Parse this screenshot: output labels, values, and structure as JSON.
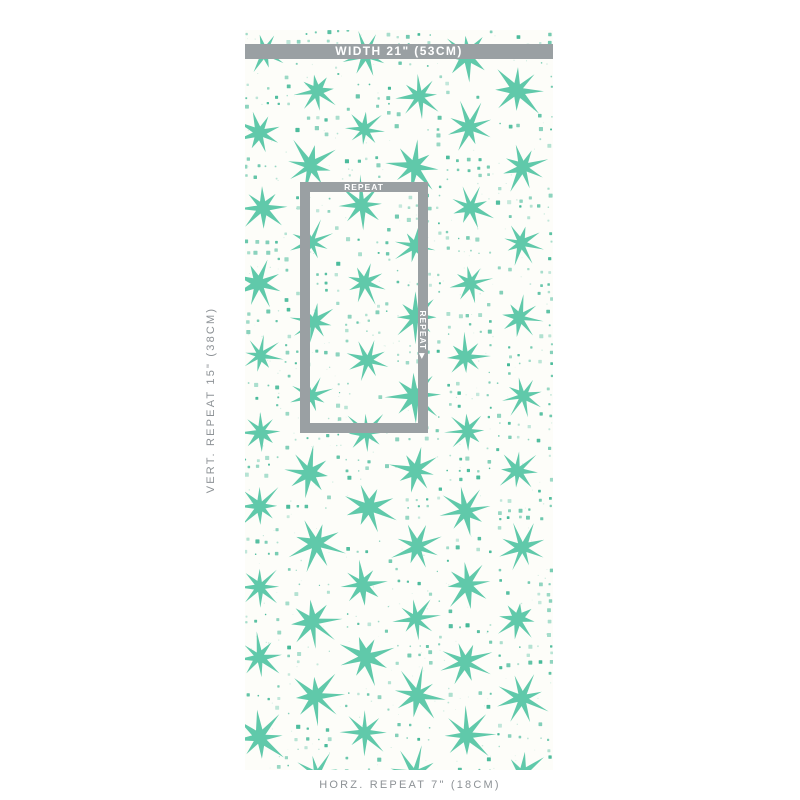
{
  "annotations": {
    "width_label": "WIDTH 21\" (53CM)",
    "vert_repeat_label": "VERT. REPEAT 15\" (38CM)",
    "horz_repeat_label": "HORZ. REPEAT 7\" (18CM)",
    "repeat_label_top": "REPEAT",
    "repeat_label_side": "REPEAT",
    "repeat_arrow": "▶",
    "caption_text_color": "#8d9296",
    "label_text_color": "#ffffff"
  },
  "swatch": {
    "background_color": "#fdfdf9",
    "star_color": "#57c6a5",
    "dot_color": "#3db694",
    "frame_color": "#9aa0a3"
  }
}
